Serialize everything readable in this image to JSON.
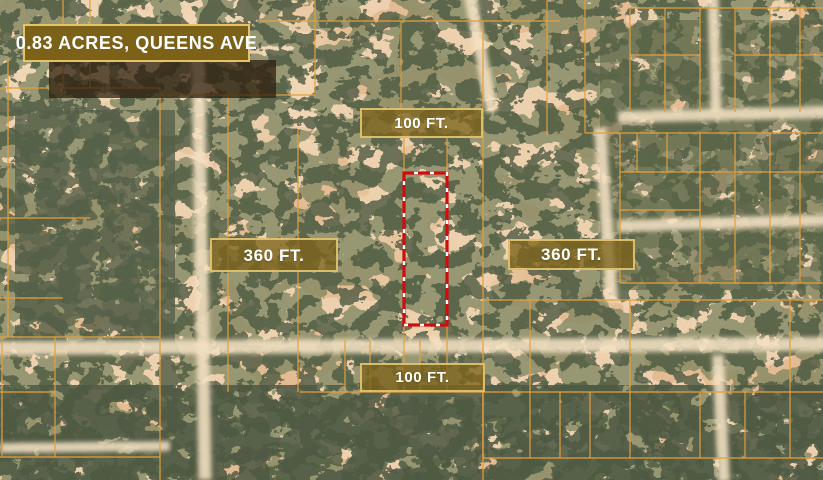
{
  "listing": {
    "title": "0.83 ACRES, QUEENS AVE",
    "acreage": "0.83 ACRES",
    "street": "QUEENS AVE"
  },
  "dimensions": {
    "top": "100 FT.",
    "bottom": "100 FT.",
    "left": "360 FT.",
    "right": "360 FT."
  },
  "map": {
    "view_type": "satellite-aerial",
    "parcel_outline_color": "#cf0d0d",
    "parcel_dash_color": "#ffffff",
    "plat_line_color": "#e2a040",
    "badge_background": "#7c6119",
    "badge_border": "#e7c367",
    "sand_color": "#e3bc93",
    "vegetation_color": "#556045"
  }
}
